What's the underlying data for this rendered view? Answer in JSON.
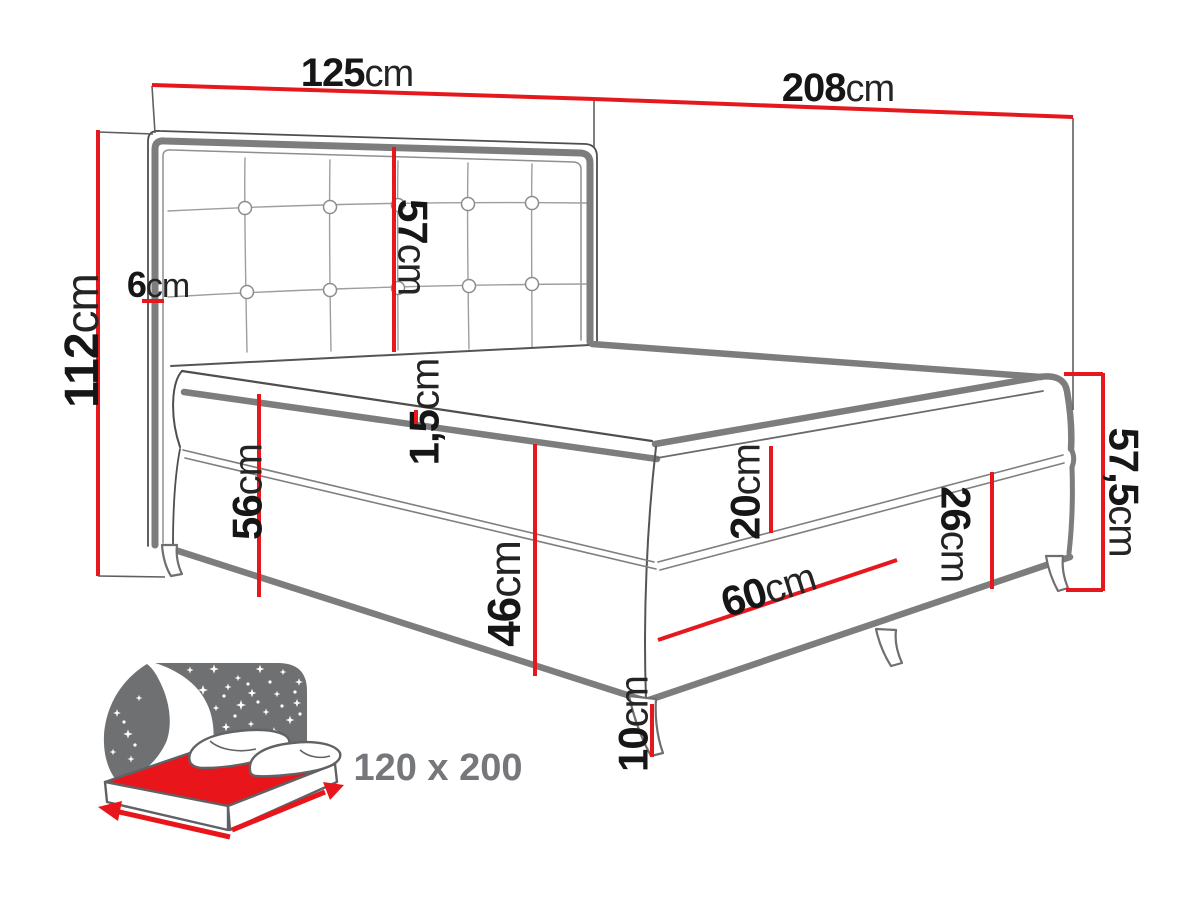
{
  "title": "Boxspring bed dimensions diagram",
  "colors": {
    "dimension_red": "#e5191d",
    "outline_gray_thick": "#7d7d7d",
    "outline_gray_thin": "#4e4e4e",
    "seam_gray": "#989898",
    "number_black": "#161616",
    "icon_sky_gray": "#6e7072",
    "icon_mattress_red": "#e8151a",
    "icon_label_gray": "#76777a"
  },
  "dimensions": {
    "headboard_width": {
      "value": "125",
      "unit": "cm"
    },
    "bed_length": {
      "value": "208",
      "unit": "cm"
    },
    "headboard_height": {
      "value": "112",
      "unit": "cm"
    },
    "headboard_depth": {
      "value": "6",
      "unit": "cm"
    },
    "headboard_panel_height": {
      "value": "57",
      "unit": "cm"
    },
    "topper_thickness": {
      "value": "1,5",
      "unit": "cm"
    },
    "side_height": {
      "value": "56",
      "unit": "cm"
    },
    "mattress_base_height": {
      "value": "46",
      "unit": "cm"
    },
    "mattress_height": {
      "value": "20",
      "unit": "cm"
    },
    "base_height": {
      "value": "26",
      "unit": "cm"
    },
    "foot_end_height": {
      "value": "57,5",
      "unit": "cm"
    },
    "foot_segment_length": {
      "value": "60",
      "unit": "cm"
    },
    "leg_height": {
      "value": "10",
      "unit": "cm"
    }
  },
  "badge": {
    "size_label": "120 x 200"
  }
}
